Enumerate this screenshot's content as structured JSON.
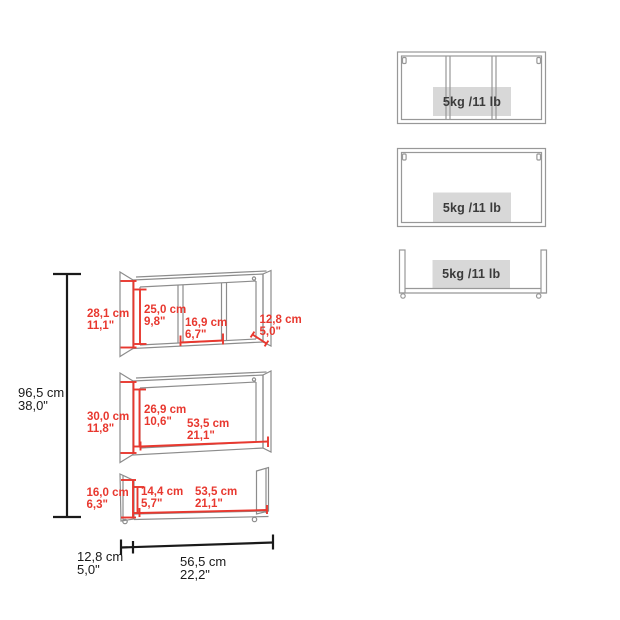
{
  "diagram": {
    "total_height": {
      "cm": "96,5 cm",
      "in": "38,0\""
    },
    "shelf_top": {
      "outer_height": {
        "cm": "28,1 cm",
        "in": "11,1\""
      },
      "inner_height": {
        "cm": "25,0 cm",
        "in": "9,8\""
      },
      "compartment_width": {
        "cm": "16,9 cm",
        "in": "6,7\""
      },
      "depth": {
        "cm": "12,8 cm",
        "in": "5,0\""
      }
    },
    "shelf_middle": {
      "outer_height": {
        "cm": "30,0 cm",
        "in": "11,8\""
      },
      "inner_height": {
        "cm": "26,9 cm",
        "in": "10,6\""
      },
      "inner_width": {
        "cm": "53,5 cm",
        "in": "21,1\""
      }
    },
    "shelf_bottom": {
      "outer_height": {
        "cm": "16,0 cm",
        "in": "6,3\""
      },
      "inner_height": {
        "cm": "14,4 cm",
        "in": "5,7\""
      },
      "inner_width": {
        "cm": "53,5 cm",
        "in": "21,1\""
      }
    },
    "base": {
      "depth": {
        "cm": "12,8 cm",
        "in": "5,0\""
      },
      "width": {
        "cm": "56,5 cm",
        "in": "22,2\""
      }
    }
  },
  "capacity_panel": {
    "shelves": [
      {
        "type": "divided-shelf",
        "capacity": "5kg /11 lb"
      },
      {
        "type": "open-frame-shelf",
        "capacity": "5kg /11 lb"
      },
      {
        "type": "ledge-shelf",
        "capacity": "5kg /11 lb"
      }
    ]
  },
  "colors": {
    "dimension_red": "#e8382f",
    "line_black": "#1a1a1a",
    "outline_gray": "#8c8c8c",
    "capacity_box_gray": "#d8d8d8",
    "background": "#ffffff"
  }
}
